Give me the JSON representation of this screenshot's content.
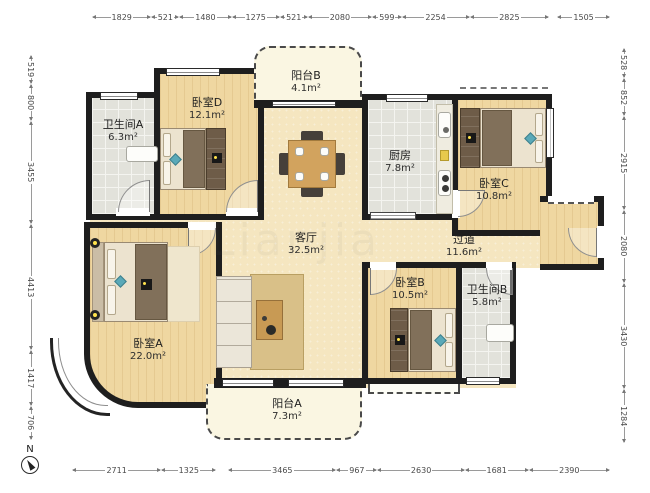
{
  "plan": {
    "compass_label": "N",
    "watermark": "Lianjia"
  },
  "rooms": {
    "bathroom_a": {
      "name": "卫生间A",
      "area": "6.3m²"
    },
    "bedroom_d": {
      "name": "卧室D",
      "area": "12.1m²"
    },
    "balcony_b": {
      "name": "阳台B",
      "area": "4.1m²"
    },
    "kitchen": {
      "name": "厨房",
      "area": "7.8m²"
    },
    "bedroom_c": {
      "name": "卧室C",
      "area": "10.8m²"
    },
    "living": {
      "name": "客厅",
      "area": "32.5m²"
    },
    "hallway": {
      "name": "过道",
      "area": "11.6m²"
    },
    "bedroom_b": {
      "name": "卧室B",
      "area": "10.5m²"
    },
    "bathroom_b": {
      "name": "卫生间B",
      "area": "5.8m²"
    },
    "bedroom_a": {
      "name": "卧室A",
      "area": "22.0m²"
    },
    "balcony_a": {
      "name": "阳台A",
      "area": "7.3m²"
    }
  },
  "dimensions": {
    "top": [
      1829,
      521,
      1480,
      1275,
      521,
      2080,
      599,
      2254,
      2825,
      1505
    ],
    "bottom": [
      2711,
      1325,
      3465,
      967,
      2630,
      1681,
      2390
    ],
    "left": [
      519,
      800,
      3455,
      4413,
      1417,
      706
    ],
    "right": [
      528,
      852,
      2915,
      2080,
      3430,
      1284
    ]
  }
}
